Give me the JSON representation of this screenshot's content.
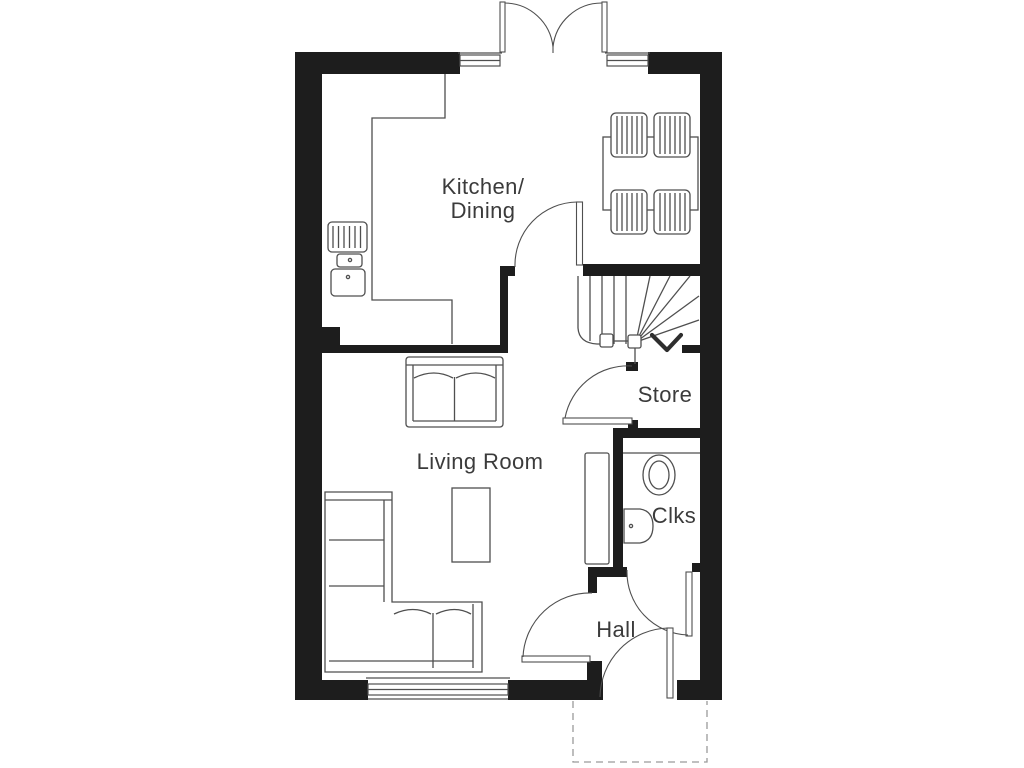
{
  "title": "House ground floor plan",
  "colors": {
    "wall": "#1d1d1d",
    "line": "#4f4f4f",
    "text": "#3b3b3b",
    "background": "#ffffff"
  },
  "rooms": {
    "kitchen_dining": {
      "label_line1": "Kitchen/",
      "label_line2": "Dining"
    },
    "living_room": {
      "label": "Living Room"
    },
    "store": {
      "label": "Store"
    },
    "cloakroom": {
      "label": "Clks"
    },
    "hall": {
      "label": "Hall"
    }
  },
  "fixtures": {
    "dining_set": "dining-table-with-four-chairs",
    "kitchen": "u-shaped-worktop-with-sink-and-drainer",
    "sofas": [
      "two-seat-sofa",
      "corner-sofa"
    ],
    "tables": [
      "coffee-table"
    ],
    "stairs": "winder-staircase-with-direction-arrow",
    "cloakroom_fixtures": [
      "toilet",
      "wash-basin"
    ],
    "hall_fixtures": [
      "tall-cupboard"
    ],
    "doors": [
      "french-doors",
      "kitchen-door",
      "store-door",
      "cloakroom-door",
      "living-room-door",
      "front-door"
    ],
    "windows": [
      "kitchen-window-left",
      "dining-window-right",
      "living-room-window"
    ],
    "outside": "porch-outline-dashed"
  }
}
